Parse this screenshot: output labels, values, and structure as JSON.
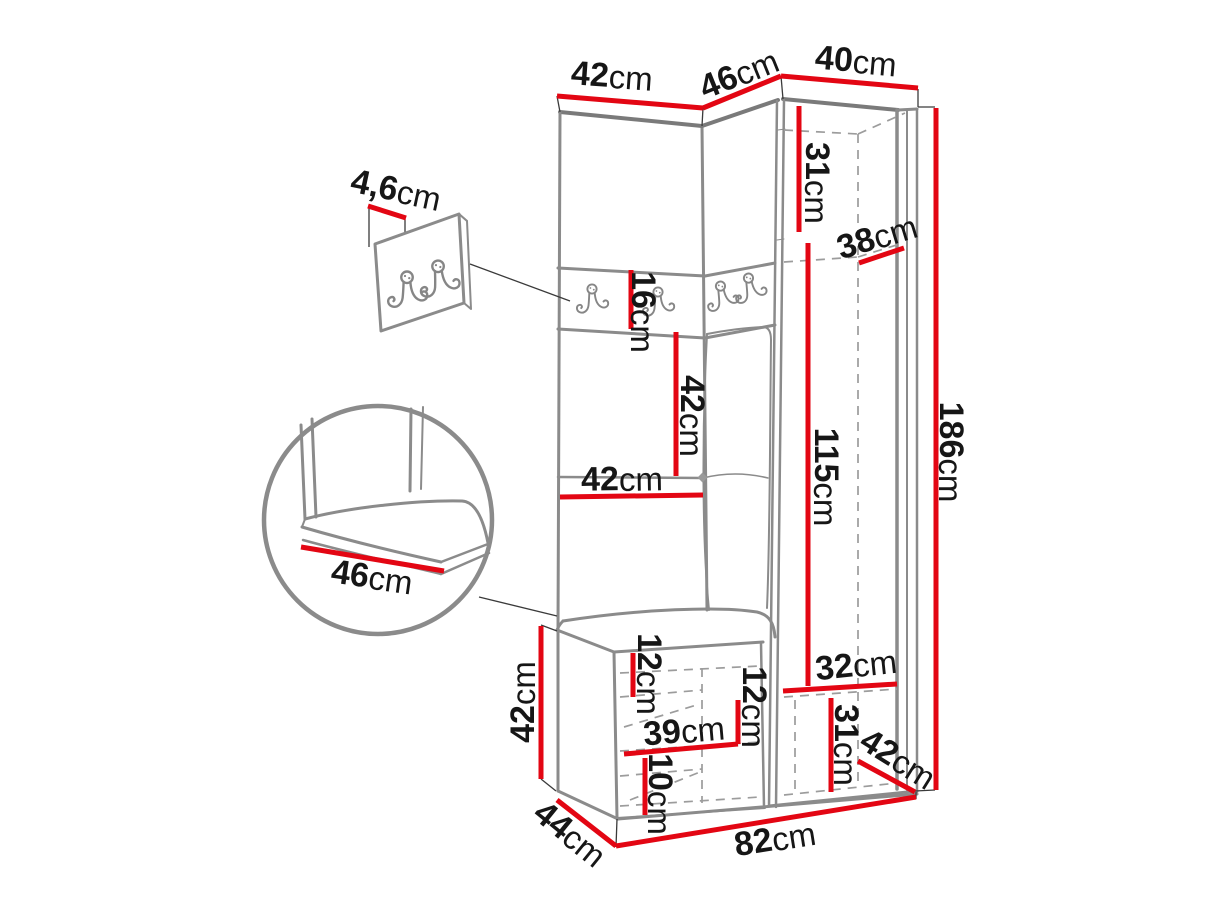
{
  "diagram": {
    "type": "furniture-dimension-diagram",
    "subject": "corner hallway wardrobe with coat hook panel, bench and shoe cabinet",
    "unit": "cm",
    "colors": {
      "dimension_line": "#e30613",
      "outline": "#8b8b8b",
      "label_text": "#161616",
      "background": "#ffffff"
    },
    "details": {
      "hook_panel_icon": "double-coat-hook",
      "main_hooks_count": 4,
      "panel_hooks_count": 2
    },
    "dimensions": [
      {
        "id": "top-width-left",
        "value": "42",
        "unit": "cm",
        "label": "42cm",
        "label_x": 612,
        "label_y": 76,
        "rotation": 4,
        "line": {
          "x1": 557,
          "y1": 96,
          "x2": 703,
          "y2": 108
        }
      },
      {
        "id": "top-width-middle",
        "value": "46",
        "unit": "cm",
        "label": "46cm",
        "label_x": 739,
        "label_y": 74,
        "rotation": -22,
        "line": {
          "x1": 703,
          "y1": 108,
          "x2": 781,
          "y2": 76
        }
      },
      {
        "id": "top-width-right",
        "value": "40",
        "unit": "cm",
        "label": "40cm",
        "label_x": 856,
        "label_y": 61,
        "rotation": 5,
        "line": {
          "x1": 781,
          "y1": 76,
          "x2": 918,
          "y2": 88
        }
      },
      {
        "id": "panel-depth",
        "value": "4,6",
        "unit": "cm",
        "label": "4,6cm",
        "label_x": 396,
        "label_y": 190,
        "rotation": 12,
        "line": {
          "x1": 368,
          "y1": 206,
          "x2": 406,
          "y2": 218
        }
      },
      {
        "id": "upper-shelf-height",
        "value": "31",
        "unit": "cm",
        "label": "31cm",
        "label_x": 817,
        "label_y": 183,
        "rotation": 90,
        "line": {
          "x1": 799,
          "y1": 106,
          "x2": 799,
          "y2": 232
        }
      },
      {
        "id": "interior-depth",
        "value": "38",
        "unit": "cm",
        "label": "38cm",
        "label_x": 877,
        "label_y": 237,
        "rotation": -17,
        "line": {
          "x1": 859,
          "y1": 263,
          "x2": 904,
          "y2": 248
        }
      },
      {
        "id": "hook-band-height",
        "value": "16",
        "unit": "cm",
        "label": "16cm",
        "label_x": 643,
        "label_y": 312,
        "rotation": 90,
        "line": {
          "x1": 631,
          "y1": 270,
          "x2": 631,
          "y2": 329
        }
      },
      {
        "id": "mid-height",
        "value": "42",
        "unit": "cm",
        "label": "42cm",
        "label_x": 692,
        "label_y": 416,
        "rotation": 90,
        "line": {
          "x1": 676,
          "y1": 332,
          "x2": 676,
          "y2": 476
        }
      },
      {
        "id": "mid-width",
        "value": "42",
        "unit": "cm",
        "label": "42cm",
        "label_x": 622,
        "label_y": 479,
        "rotation": -1,
        "line": {
          "x1": 560,
          "y1": 497,
          "x2": 703,
          "y2": 495
        }
      },
      {
        "id": "interior-height",
        "value": "115",
        "unit": "cm",
        "label": "115cm",
        "label_x": 826,
        "label_y": 477,
        "rotation": 90,
        "line": {
          "x1": 808,
          "y1": 243,
          "x2": 808,
          "y2": 686
        }
      },
      {
        "id": "total-height",
        "value": "186",
        "unit": "cm",
        "label": "186cm",
        "label_x": 951,
        "label_y": 452,
        "rotation": 90,
        "line": {
          "x1": 936,
          "y1": 108,
          "x2": 936,
          "y2": 790
        }
      },
      {
        "id": "bench-seat-depth",
        "value": "46",
        "unit": "cm",
        "label": "46cm",
        "label_x": 372,
        "label_y": 577,
        "rotation": 8,
        "line": {
          "x1": 301,
          "y1": 547,
          "x2": 444,
          "y2": 571
        }
      },
      {
        "id": "bench-height",
        "value": "42",
        "unit": "cm",
        "label": "42cm",
        "label_x": 523,
        "label_y": 702,
        "rotation": -90,
        "line": {
          "x1": 541,
          "y1": 626,
          "x2": 541,
          "y2": 779
        }
      },
      {
        "id": "shoe-top-opening",
        "value": "12",
        "unit": "cm",
        "label": "12cm",
        "label_x": 649,
        "label_y": 674,
        "rotation": 90,
        "line": {
          "x1": 633,
          "y1": 653,
          "x2": 633,
          "y2": 697
        }
      },
      {
        "id": "shoe-shelf-width",
        "value": "39",
        "unit": "cm",
        "label": "39cm",
        "label_x": 684,
        "label_y": 731,
        "rotation": -5,
        "line": {
          "x1": 624,
          "y1": 754,
          "x2": 738,
          "y2": 744
        }
      },
      {
        "id": "shoe-mid-opening",
        "value": "12",
        "unit": "cm",
        "label": "12cm",
        "label_x": 754,
        "label_y": 707,
        "rotation": 90,
        "line": {
          "x1": 738,
          "y1": 700,
          "x2": 738,
          "y2": 744
        }
      },
      {
        "id": "shoe-bottom-opening",
        "value": "10",
        "unit": "cm",
        "label": "10cm",
        "label_x": 660,
        "label_y": 794,
        "rotation": 90,
        "line": {
          "x1": 645,
          "y1": 758,
          "x2": 645,
          "y2": 815
        }
      },
      {
        "id": "right-bottom-width",
        "value": "32",
        "unit": "cm",
        "label": "32cm",
        "label_x": 856,
        "label_y": 665,
        "rotation": -6,
        "line": {
          "x1": 783,
          "y1": 691,
          "x2": 897,
          "y2": 684
        }
      },
      {
        "id": "right-bottom-height",
        "value": "31",
        "unit": "cm",
        "label": "31cm",
        "label_x": 846,
        "label_y": 745,
        "rotation": 90,
        "line": {
          "x1": 831,
          "y1": 698,
          "x2": 831,
          "y2": 792
        }
      },
      {
        "id": "right-base-depth",
        "value": "42",
        "unit": "cm",
        "label": "42cm",
        "label_x": 898,
        "label_y": 759,
        "rotation": 32,
        "line": {
          "x1": 858,
          "y1": 761,
          "x2": 915,
          "y2": 792
        }
      },
      {
        "id": "base-depth",
        "value": "44",
        "unit": "cm",
        "label": "44cm",
        "label_x": 570,
        "label_y": 834,
        "rotation": 39,
        "line": {
          "x1": 557,
          "y1": 800,
          "x2": 616,
          "y2": 846
        }
      },
      {
        "id": "base-width",
        "value": "82",
        "unit": "cm",
        "label": "82cm",
        "label_x": 775,
        "label_y": 839,
        "rotation": -9,
        "line": {
          "x1": 616,
          "y1": 846,
          "x2": 916,
          "y2": 797
        }
      }
    ]
  }
}
